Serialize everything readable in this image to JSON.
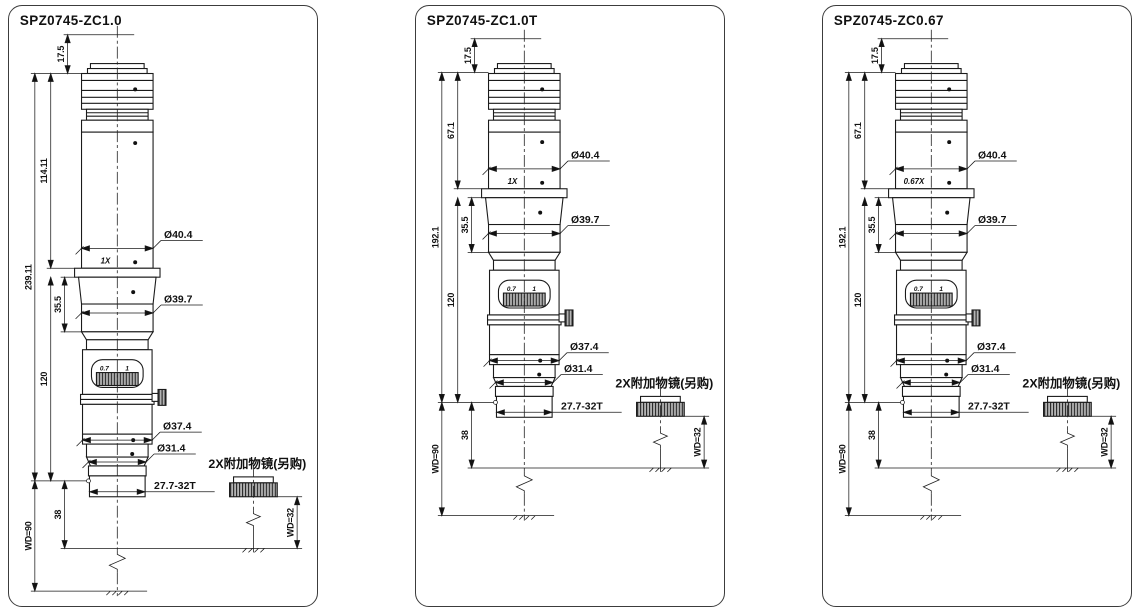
{
  "background": "#ffffff",
  "line_color": "#1a1a1a",
  "panels": [
    {
      "title": "SPZ0745-ZC1.0",
      "magnification": "1X",
      "dims": {
        "top": "17.5",
        "upper": "114.11",
        "total": "239.11",
        "cone": "35.5",
        "lower": "120",
        "offset": "38",
        "wd": "WD=90",
        "dia1": "Ø40.4",
        "dia2": "Ø39.7",
        "dia3": "Ø37.4",
        "dia4": "Ø31.4",
        "thread": "27.7-32T"
      },
      "dial": {
        "left": "0.7",
        "right": "1"
      },
      "attachment": {
        "label": "2X附加物镜(另购)",
        "wd": "WD=32"
      }
    },
    {
      "title": "SPZ0745-ZC1.0T",
      "magnification": "1X",
      "dims": {
        "top": "17.5",
        "upper": "67.1",
        "total": "192.1",
        "cone": "35.5",
        "lower": "120",
        "offset": "38",
        "wd": "WD=90",
        "dia1": "Ø40.4",
        "dia2": "Ø39.7",
        "dia3": "Ø37.4",
        "dia4": "Ø31.4",
        "thread": "27.7-32T"
      },
      "dial": {
        "left": "0.7",
        "right": "1"
      },
      "attachment": {
        "label": "2X附加物镜(另购)",
        "wd": "WD=32"
      }
    },
    {
      "title": "SPZ0745-ZC0.67",
      "magnification": "0.67X",
      "dims": {
        "top": "17.5",
        "upper": "67.1",
        "total": "192.1",
        "cone": "35.5",
        "lower": "120",
        "offset": "38",
        "wd": "WD=90",
        "dia1": "Ø40.4",
        "dia2": "Ø39.7",
        "dia3": "Ø37.4",
        "dia4": "Ø31.4",
        "thread": "27.7-32T"
      },
      "dial": {
        "left": "0.7",
        "right": "1"
      },
      "attachment": {
        "label": "2X附加物镜(另购)",
        "wd": "WD=32"
      }
    }
  ]
}
